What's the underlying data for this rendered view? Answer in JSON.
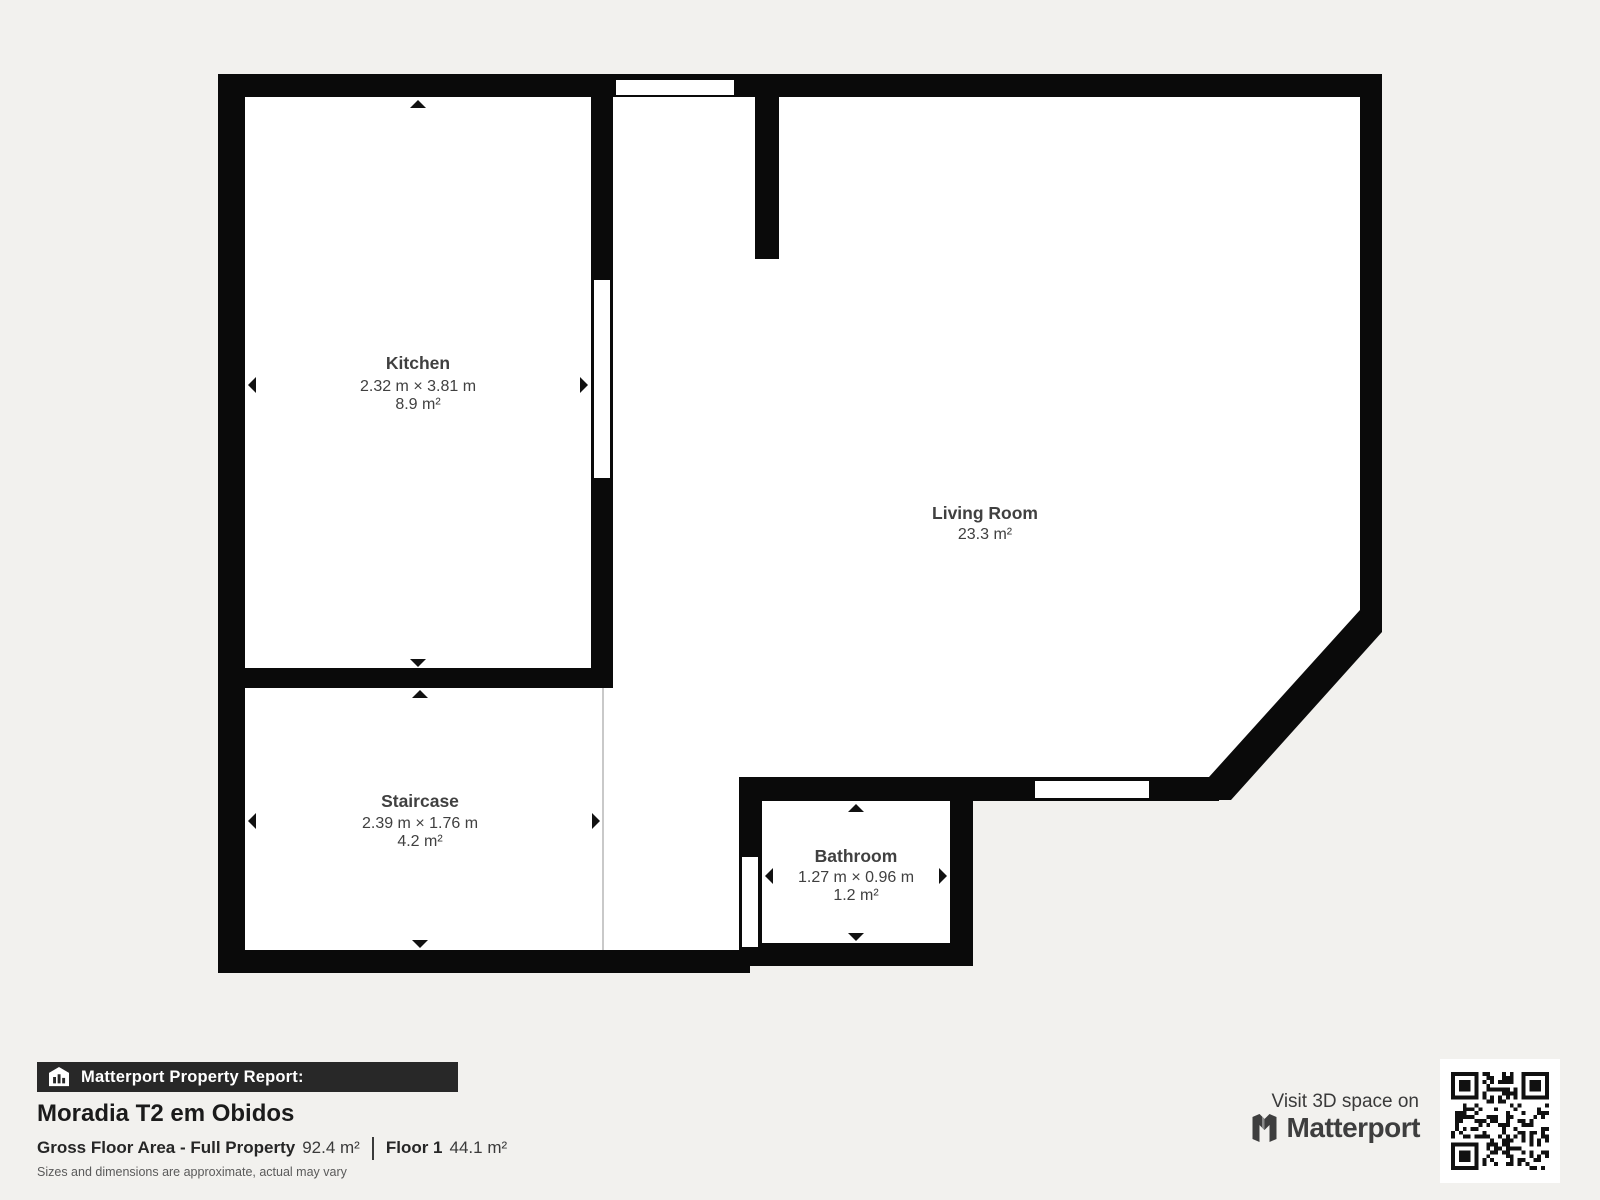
{
  "colors": {
    "background": "#f2f1ee",
    "wall": "#0a0a0a",
    "floor": "#ffffff",
    "report_bar": "#282828",
    "label_text": "#404040"
  },
  "floorplan": {
    "rooms": [
      {
        "name": "Kitchen",
        "dimensions": "2.32 m × 3.81 m",
        "area": "8.9 m²"
      },
      {
        "name": "Living Room",
        "dimensions": "",
        "area": "23.3 m²"
      },
      {
        "name": "Staircase",
        "dimensions": "2.39 m × 1.76 m",
        "area": "4.2 m²"
      },
      {
        "name": "Bathroom",
        "dimensions": "1.27 m × 0.96 m",
        "area": "1.2 m²"
      }
    ]
  },
  "report": {
    "bar_label": "Matterport Property Report:",
    "title": "Moradia T2 em Obidos",
    "stats": [
      {
        "label": "Gross Floor Area - Full Property",
        "value": "92.4 m²"
      },
      {
        "label": "Floor 1",
        "value": "44.1 m²"
      }
    ],
    "disclaimer": "Sizes and dimensions are approximate, actual may vary"
  },
  "footer": {
    "visit_text": "Visit 3D space on",
    "brand": "Matterport"
  }
}
